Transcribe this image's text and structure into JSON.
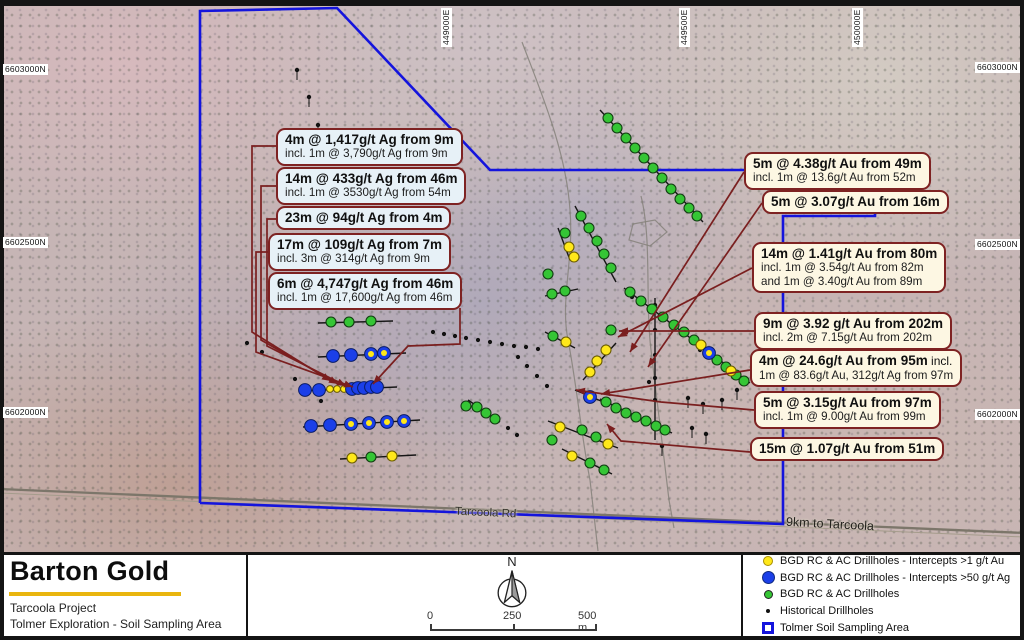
{
  "map": {
    "colors": {
      "boundary": "#1414dd",
      "leader": "#7a1f1f",
      "green": "#35c535",
      "yellow": "#ffe81a",
      "blue": "#1b3fe8",
      "track": "#85817a",
      "road": "#7c766a"
    },
    "grid_labels": {
      "top": [
        {
          "text": "449000E",
          "x": 441,
          "y": 47
        },
        {
          "text": "449500E",
          "x": 679,
          "y": 47
        },
        {
          "text": "450000E",
          "x": 852,
          "y": 47
        }
      ],
      "left": [
        {
          "text": "6603000N",
          "x": 3,
          "y": 64
        },
        {
          "text": "6602500N",
          "x": 3,
          "y": 237
        },
        {
          "text": "6602000N",
          "x": 3,
          "y": 407
        }
      ],
      "right": [
        {
          "text": "6603000N",
          "x": 975,
          "y": 62
        },
        {
          "text": "6602500N",
          "x": 975,
          "y": 239
        },
        {
          "text": "6602000N",
          "x": 975,
          "y": 409
        }
      ]
    },
    "road_label": "Tarcoola Rd",
    "distance_label": "9km to Tarcoola",
    "polygon": [
      [
        200,
        503
      ],
      [
        200,
        11
      ],
      [
        337,
        8
      ],
      [
        490,
        170
      ],
      [
        875,
        170
      ],
      [
        875,
        216
      ],
      [
        783,
        216
      ],
      [
        783,
        524
      ],
      [
        200,
        503
      ]
    ],
    "road": [
      [
        0,
        489
      ],
      [
        1024,
        533
      ]
    ],
    "grey_paths": [
      "M 522,42 C 540,90 566,150 570,210 C 574,260 560,300 568,340 C 576,380 582,440 590,480 L 598,551",
      "M 641,196 C 652,240 645,300 651,350 C 657,400 663,450 669,500 L 674,528",
      "M 633,224 L 655,220 L 667,232 L 650,246 L 629,240 Z"
    ],
    "traces": [
      [
        318,
        323,
        393,
        321
      ],
      [
        318,
        357,
        406,
        353
      ],
      [
        299,
        391,
        397,
        387
      ],
      [
        303,
        427,
        420,
        420
      ],
      [
        340,
        459,
        416,
        455
      ],
      [
        468,
        400,
        500,
        422
      ],
      [
        600,
        110,
        703,
        222
      ],
      [
        575,
        206,
        616,
        282
      ],
      [
        558,
        228,
        570,
        260
      ],
      [
        545,
        296,
        578,
        289
      ],
      [
        624,
        288,
        750,
        383
      ],
      [
        583,
        380,
        616,
        343
      ],
      [
        545,
        332,
        575,
        348
      ],
      [
        575,
        390,
        608,
        404
      ],
      [
        600,
        399,
        672,
        433
      ],
      [
        548,
        421,
        618,
        448
      ],
      [
        562,
        449,
        612,
        474
      ],
      [
        655,
        298,
        655,
        440
      ]
    ],
    "black_tails": [
      [
        297,
        70
      ],
      [
        309,
        97
      ],
      [
        318,
        125
      ],
      [
        688,
        398
      ],
      [
        703,
        404
      ],
      [
        722,
        400
      ],
      [
        692,
        428
      ],
      [
        706,
        434
      ],
      [
        662,
        446
      ],
      [
        737,
        390
      ]
    ],
    "markers": {
      "green": [
        [
          331,
          322
        ],
        [
          349,
          322
        ],
        [
          371,
          321
        ],
        [
          371,
          457
        ],
        [
          466,
          406
        ],
        [
          477,
          407
        ],
        [
          486,
          413
        ],
        [
          495,
          419
        ],
        [
          608,
          118
        ],
        [
          617,
          128
        ],
        [
          626,
          138
        ],
        [
          635,
          148
        ],
        [
          644,
          158
        ],
        [
          653,
          168
        ],
        [
          662,
          178
        ],
        [
          671,
          189
        ],
        [
          680,
          199
        ],
        [
          689,
          208
        ],
        [
          697,
          216
        ],
        [
          581,
          216
        ],
        [
          589,
          228
        ],
        [
          597,
          241
        ],
        [
          604,
          254
        ],
        [
          611,
          268
        ],
        [
          548,
          274
        ],
        [
          565,
          233
        ],
        [
          552,
          294
        ],
        [
          565,
          291
        ],
        [
          630,
          292
        ],
        [
          641,
          301
        ],
        [
          652,
          309
        ],
        [
          663,
          317
        ],
        [
          674,
          325
        ],
        [
          684,
          332
        ],
        [
          694,
          340
        ],
        [
          717,
          360
        ],
        [
          726,
          367
        ],
        [
          736,
          375
        ],
        [
          744,
          381
        ],
        [
          611,
          330
        ],
        [
          553,
          336
        ],
        [
          606,
          402
        ],
        [
          616,
          408
        ],
        [
          626,
          413
        ],
        [
          636,
          417
        ],
        [
          646,
          421
        ],
        [
          656,
          426
        ],
        [
          665,
          430
        ],
        [
          582,
          430
        ],
        [
          596,
          437
        ],
        [
          552,
          440
        ],
        [
          590,
          463
        ],
        [
          604,
          470
        ]
      ],
      "yellow": [
        [
          352,
          458
        ],
        [
          392,
          456
        ],
        [
          566,
          342
        ],
        [
          606,
          350
        ],
        [
          597,
          361
        ],
        [
          590,
          372
        ],
        [
          701,
          345
        ],
        [
          731,
          371
        ],
        [
          569,
          247
        ],
        [
          574,
          257
        ],
        [
          560,
          427
        ],
        [
          608,
          444
        ],
        [
          572,
          456
        ]
      ],
      "yellow_small": [
        [
          330,
          389
        ],
        [
          337,
          389
        ],
        [
          344,
          389
        ]
      ],
      "blue": [
        [
          333,
          356
        ],
        [
          351,
          355
        ],
        [
          305,
          390
        ],
        [
          319,
          390
        ],
        [
          352,
          389
        ],
        [
          358,
          388
        ],
        [
          364,
          388
        ],
        [
          371,
          387
        ],
        [
          377,
          387
        ],
        [
          311,
          426
        ],
        [
          330,
          425
        ]
      ],
      "blue_yellow": [
        [
          371,
          354
        ],
        [
          384,
          353
        ],
        [
          351,
          424
        ],
        [
          369,
          423
        ],
        [
          387,
          422
        ],
        [
          404,
          421
        ],
        [
          709,
          353
        ],
        [
          590,
          397
        ]
      ],
      "black": [
        [
          433,
          332
        ],
        [
          444,
          334
        ],
        [
          455,
          336
        ],
        [
          466,
          338
        ],
        [
          478,
          340
        ],
        [
          490,
          342
        ],
        [
          502,
          344
        ],
        [
          514,
          346
        ],
        [
          526,
          347
        ],
        [
          538,
          349
        ],
        [
          518,
          357
        ],
        [
          527,
          366
        ],
        [
          537,
          376
        ],
        [
          547,
          386
        ],
        [
          508,
          428
        ],
        [
          517,
          435
        ],
        [
          247,
          343
        ],
        [
          262,
          352
        ],
        [
          295,
          379
        ],
        [
          321,
          401
        ],
        [
          655,
          305
        ],
        [
          655,
          330
        ],
        [
          655,
          355
        ],
        [
          655,
          378
        ],
        [
          655,
          400
        ],
        [
          632,
          297
        ],
        [
          700,
          350
        ],
        [
          649,
          382
        ]
      ]
    },
    "leaders": [
      {
        "pts": [
          [
            277,
            146
          ],
          [
            252,
            146
          ],
          [
            252,
            332
          ],
          [
            331,
            381
          ]
        ]
      },
      {
        "pts": [
          [
            277,
            186
          ],
          [
            261,
            186
          ],
          [
            261,
            340
          ],
          [
            338,
            384
          ]
        ]
      },
      {
        "pts": [
          [
            277,
            219
          ],
          [
            267,
            219
          ],
          [
            267,
            346
          ],
          [
            346,
            386
          ]
        ]
      },
      {
        "pts": [
          [
            269,
            252
          ],
          [
            256,
            252
          ],
          [
            256,
            352
          ],
          [
            353,
            387
          ]
        ]
      },
      {
        "pts": [
          [
            460,
            308
          ],
          [
            460,
            344
          ],
          [
            408,
            346
          ],
          [
            373,
            384
          ]
        ]
      },
      {
        "pts": [
          [
            744,
            172
          ],
          [
            630,
            352
          ]
        ]
      },
      {
        "pts": [
          [
            762,
            203
          ],
          [
            648,
            367
          ]
        ]
      },
      {
        "pts": [
          [
            752,
            268
          ],
          [
            618,
            337
          ]
        ]
      },
      {
        "pts": [
          [
            754,
            331
          ],
          [
            619,
            331
          ]
        ]
      },
      {
        "pts": [
          [
            750,
            370
          ],
          [
            601,
            394
          ]
        ]
      },
      {
        "pts": [
          [
            754,
            410
          ],
          [
            661,
            402
          ],
          [
            576,
            390
          ]
        ]
      },
      {
        "pts": [
          [
            750,
            452
          ],
          [
            621,
            441
          ],
          [
            607,
            424
          ]
        ]
      }
    ]
  },
  "callouts_left": [
    {
      "x": 276,
      "y": 128,
      "line1": "4m @ 1,417g/t Ag from 9m",
      "line2": "incl. 1m @ 3,790g/t Ag from 9m"
    },
    {
      "x": 276,
      "y": 167,
      "line1": "14m @ 433g/t Ag from 46m",
      "line2": "incl. 1m @ 3530g/t Ag from 54m"
    },
    {
      "x": 276,
      "y": 206,
      "line1": "23m @ 94g/t Ag from 4m"
    },
    {
      "x": 268,
      "y": 233,
      "line1": "17m @ 109g/t Ag from 7m",
      "line2": "incl. 3m @ 314g/t Ag from 9m"
    },
    {
      "x": 268,
      "y": 272,
      "line1": "6m @ 4,747g/t Ag from 46m",
      "line2": "incl. 1m @ 17,600g/t Ag from 46m"
    }
  ],
  "callouts_right": [
    {
      "x": 744,
      "y": 152,
      "line1": "5m @ 4.38g/t Au from 49m",
      "line2": "incl. 1m @ 13.6g/t Au from 52m"
    },
    {
      "x": 762,
      "y": 190,
      "line1": "5m @ 3.07g/t Au from 16m"
    },
    {
      "x": 752,
      "y": 242,
      "line1": "14m @ 1.41g/t Au from 80m",
      "line2": "incl. 1m @ 3.54g/t Au from 82m",
      "line3": "and 1m @ 3.40g/t Au from 89m"
    },
    {
      "x": 754,
      "y": 312,
      "line1": "9m @ 3.92 g/t Au from 202m",
      "line2": "incl. 2m @ 7.15g/t Au from 202m"
    },
    {
      "x": 750,
      "y": 349,
      "line1": "4m @ 24.6g/t Au from 95m",
      "line1b": " incl.",
      "line2": "1m @ 83.6g/t Au, 312g/t Ag from 97m"
    },
    {
      "x": 754,
      "y": 391,
      "line1": "5m @ 3.15g/t Au from 97m",
      "line2": "incl. 1m @ 9.00g/t Au from 99m"
    },
    {
      "x": 750,
      "y": 437,
      "line1": "15m @ 1.07g/t Au from 51m"
    }
  ],
  "footer": {
    "logo_title": "Barton Gold",
    "subtitle1": "Tarcoola Project",
    "subtitle2": "Tolmer Exploration - Soil Sampling Area",
    "north_label": "N",
    "scale": {
      "t0": "0",
      "t1": "250",
      "t2": "500 m"
    },
    "legend": {
      "items": [
        {
          "label": "BGD RC & AC Drillholes - Intercepts >1 g/t Au"
        },
        {
          "label": "BGD RC & AC Drillholes - Intercepts >50 g/t Ag"
        },
        {
          "label": "BGD RC & AC Drillholes"
        },
        {
          "label": "Historical Drillholes"
        },
        {
          "label": "Tolmer Soil Sampling Area"
        }
      ]
    }
  }
}
